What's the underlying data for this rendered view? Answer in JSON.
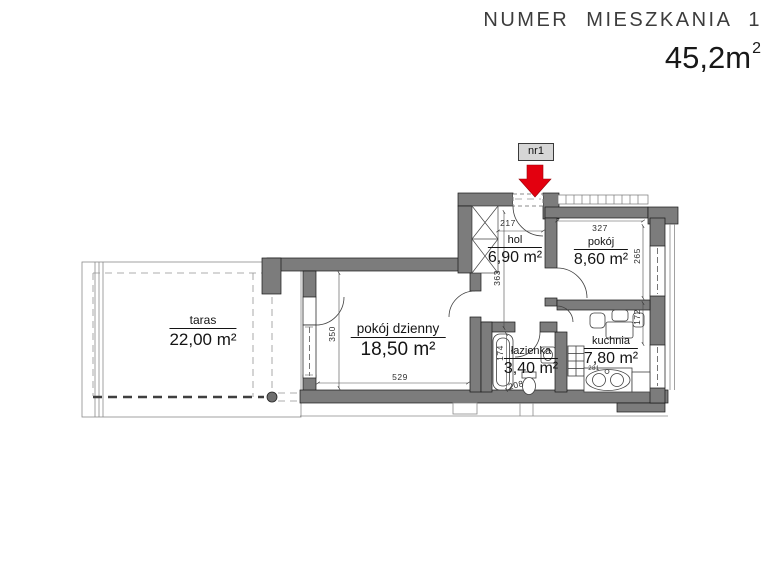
{
  "header": {
    "title": "NUMER MIESZKANIA 1",
    "total_area": "45,2m",
    "total_area_sup": "2"
  },
  "marker": {
    "label": "nr1"
  },
  "rooms": {
    "taras": {
      "name": "taras",
      "area": "22,00 m²"
    },
    "pokoj_dzienny": {
      "name": "pokój dzienny",
      "area": "18,50 m²"
    },
    "hol": {
      "name": "hol",
      "area": "6,90 m²"
    },
    "pokoj": {
      "name": "pokój",
      "area": "8,60 m²"
    },
    "kuchnia": {
      "name": "kuchnia",
      "area": "7,80 m²"
    },
    "lazienka": {
      "name": "łazienka",
      "area": "3,40 m²"
    }
  },
  "dimensions": {
    "hol_width": "217",
    "hol_depth": "363",
    "pokoj_width": "327",
    "pokoj_depth": "265",
    "kuchnia_window": "172",
    "living_depth": "350",
    "living_width": "529",
    "lazienka_depth": "174",
    "lazienka_width": "208",
    "sink_counter": "281"
  },
  "colors": {
    "wall": "#7c7c7c",
    "arrow_red": "#e3000f",
    "line": "#3a3a3a"
  }
}
